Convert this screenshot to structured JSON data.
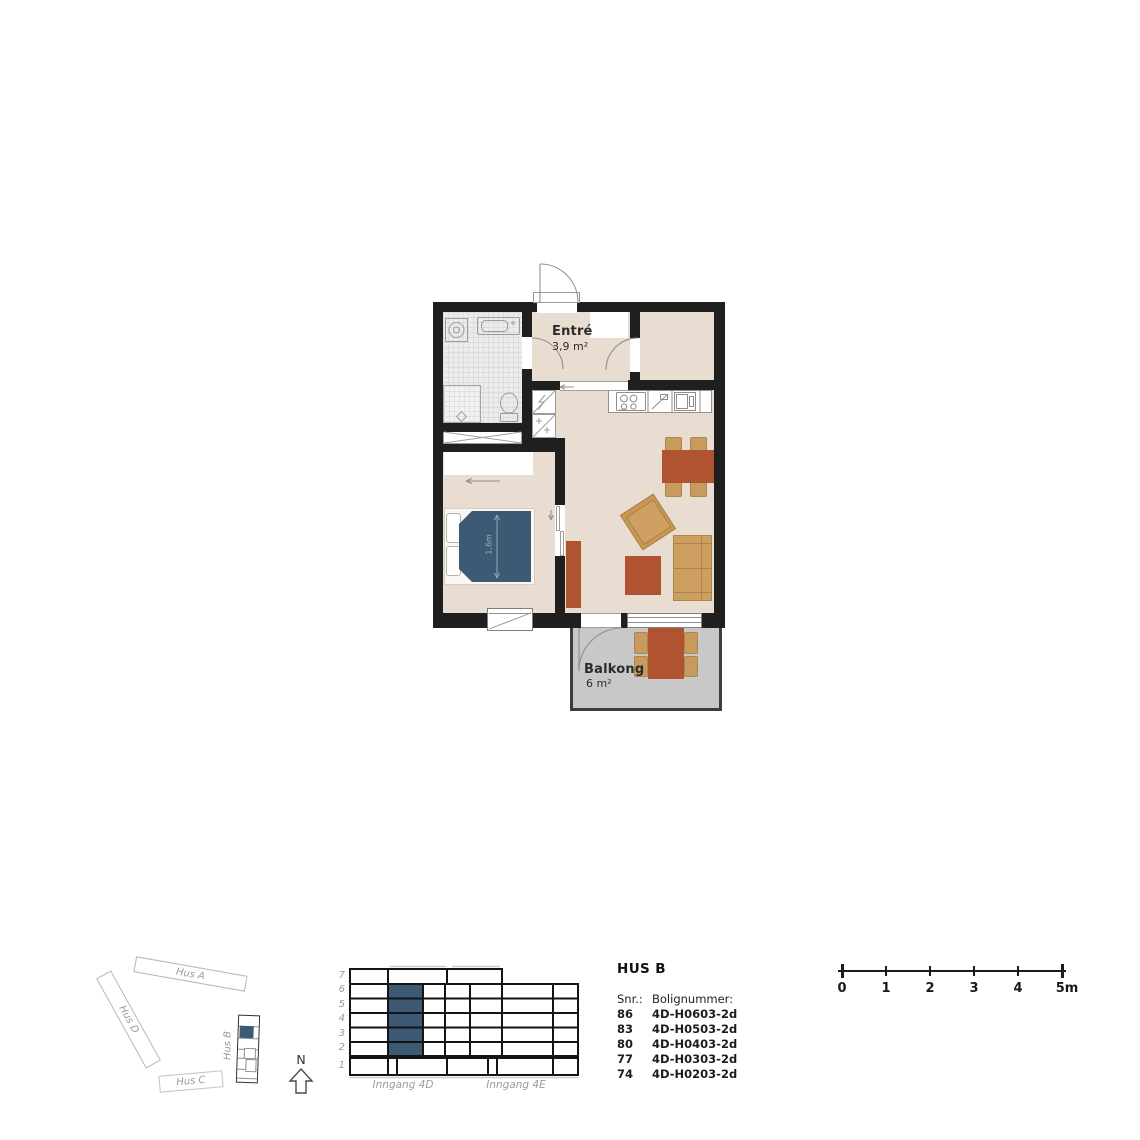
{
  "floorplan": {
    "rooms": {
      "bad": {
        "name": "Bad",
        "area": "4,7 m²"
      },
      "entre": {
        "name": "Entré",
        "area": "3,9 m²"
      },
      "bod": {
        "name": "Bod",
        "area": "3,0 m²"
      },
      "sov1": {
        "name": "Sov 1",
        "area": "10,6 m²"
      },
      "stue": {
        "name_line1": "Stue/",
        "name_line2": "kjøkken",
        "area": "19,8 m²"
      },
      "balkong": {
        "name": "Balkong",
        "area": "6 m²"
      }
    },
    "bed_width": "1,6m",
    "colors": {
      "wall": "#1f1f1f",
      "floor": "#e9ddd1",
      "accent_blue": "#3c5a74",
      "terracotta": "#b05330",
      "tan": "#c99a5d",
      "balcony_floor": "#c8c8c8"
    }
  },
  "site_plan": {
    "hus_a": "Hus A",
    "hus_b": "Hus B",
    "hus_c": "Hus C",
    "hus_d": "Hus D",
    "north": "N"
  },
  "section": {
    "floors": [
      "7",
      "6",
      "5",
      "4",
      "3",
      "2",
      "1"
    ],
    "entrance_left": "Inngang 4D",
    "entrance_right": "Inngang 4E"
  },
  "legend": {
    "title": "HUS B",
    "col_snr": "Snr.:",
    "col_bolig": "Bolignummer:",
    "rows": [
      {
        "snr": "86",
        "bolig": "4D-H0603-2d"
      },
      {
        "snr": "83",
        "bolig": "4D-H0503-2d"
      },
      {
        "snr": "80",
        "bolig": "4D-H0403-2d"
      },
      {
        "snr": "77",
        "bolig": "4D-H0303-2d"
      },
      {
        "snr": "74",
        "bolig": "4D-H0203-2d"
      }
    ]
  },
  "scalebar": {
    "labels": [
      "0",
      "1",
      "2",
      "3",
      "4",
      "5m"
    ]
  }
}
